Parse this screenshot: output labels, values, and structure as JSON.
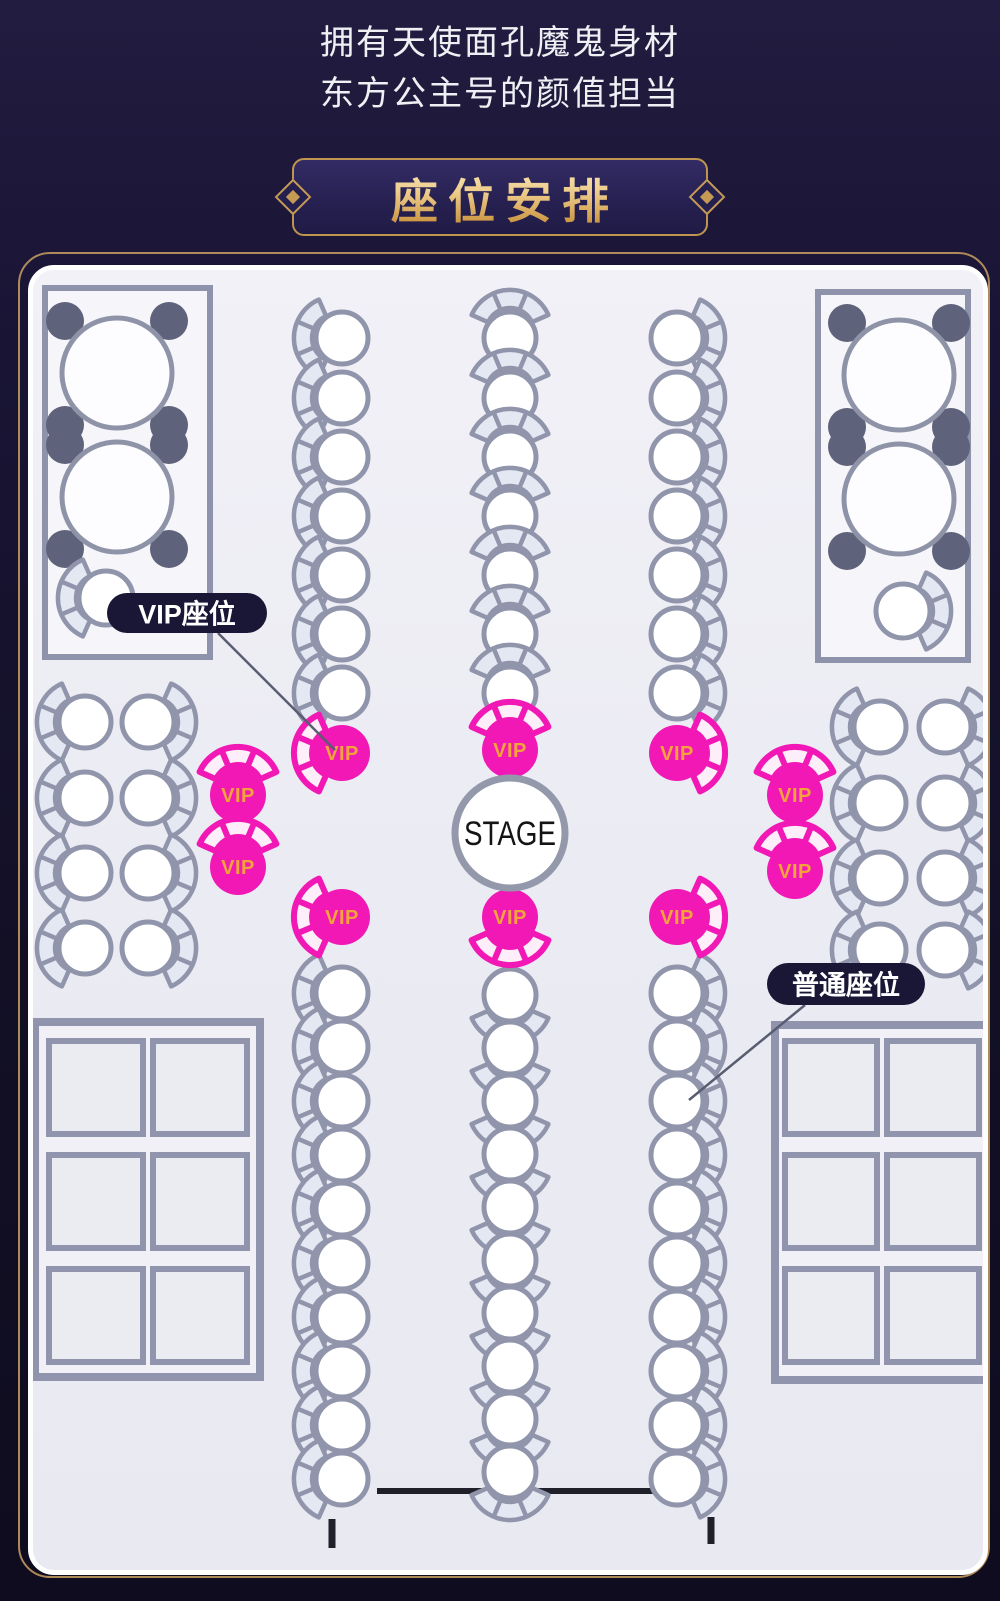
{
  "header": {
    "line1": "拥有天使面孔魔鬼身材",
    "line2": "东方公主号的颜值担当"
  },
  "banner": {
    "title": "座位安排"
  },
  "stage": {
    "label": "STAGE"
  },
  "seat_labels": {
    "vip": "VIP座位",
    "regular": "普通座位",
    "vip_seat_text": "VIP"
  },
  "colors": {
    "page_bg": "#17122c",
    "banner_border": "#c0954f",
    "gold_outline": "#c9a063",
    "map_bg": "#eeedf5",
    "chair_stroke": "#9095ab",
    "chair_fill": "#ffffff",
    "fan_fill": "#e3e8f2",
    "vip_pink": "#f118b6",
    "vip_fan_fill": "#fdeef9",
    "vip_text": "#f2a43a",
    "dark_chair": "#5e627a",
    "table_fill": "#fdfdff",
    "table_stroke": "#8e93a8",
    "rect_stroke": "#8e92aa",
    "rect_fill": "#f6f6fa",
    "grid_stroke": "#9094ac",
    "grid_fill": "#ebebf2",
    "grid_outer_fill": "#f0f0f6",
    "stage_stroke": "#9398ab",
    "stage_text": "#141414",
    "pill_bg": "#191636",
    "pill_text": "#ffffff",
    "leader_line": "#585d72",
    "runway": "#20202b"
  },
  "seat_map": {
    "viewbox": [
      28,
      265,
      950,
      1300
    ],
    "regular_seats": [
      [
        337,
        333,
        "left"
      ],
      [
        337,
        393,
        "left"
      ],
      [
        337,
        452,
        "left"
      ],
      [
        337,
        511,
        "left"
      ],
      [
        337,
        570,
        "left"
      ],
      [
        337,
        629,
        "left"
      ],
      [
        337,
        688,
        "left"
      ],
      [
        505,
        333,
        "up"
      ],
      [
        505,
        393,
        "up"
      ],
      [
        505,
        452,
        "up"
      ],
      [
        505,
        511,
        "up"
      ],
      [
        505,
        570,
        "up"
      ],
      [
        505,
        629,
        "up"
      ],
      [
        505,
        688,
        "up"
      ],
      [
        672,
        333,
        "right"
      ],
      [
        672,
        393,
        "right"
      ],
      [
        672,
        452,
        "right"
      ],
      [
        672,
        511,
        "right"
      ],
      [
        672,
        570,
        "right"
      ],
      [
        672,
        629,
        "right"
      ],
      [
        672,
        688,
        "right"
      ],
      [
        337,
        988,
        "left"
      ],
      [
        337,
        1042,
        "left"
      ],
      [
        337,
        1096,
        "left"
      ],
      [
        337,
        1150,
        "left"
      ],
      [
        337,
        1204,
        "left"
      ],
      [
        337,
        1258,
        "left"
      ],
      [
        337,
        1312,
        "left"
      ],
      [
        337,
        1366,
        "left"
      ],
      [
        337,
        1420,
        "left"
      ],
      [
        337,
        1474,
        "left"
      ],
      [
        505,
        990,
        "down"
      ],
      [
        505,
        1043,
        "down"
      ],
      [
        505,
        1096,
        "down"
      ],
      [
        505,
        1149,
        "down"
      ],
      [
        505,
        1202,
        "down"
      ],
      [
        505,
        1255,
        "down"
      ],
      [
        505,
        1308,
        "down"
      ],
      [
        505,
        1361,
        "down"
      ],
      [
        505,
        1414,
        "down"
      ],
      [
        505,
        1467,
        "down"
      ],
      [
        672,
        988,
        "right"
      ],
      [
        672,
        1042,
        "right"
      ],
      [
        672,
        1096,
        "right"
      ],
      [
        672,
        1150,
        "right"
      ],
      [
        672,
        1204,
        "right"
      ],
      [
        672,
        1258,
        "right"
      ],
      [
        672,
        1312,
        "right"
      ],
      [
        672,
        1366,
        "right"
      ],
      [
        672,
        1420,
        "right"
      ],
      [
        672,
        1474,
        "right"
      ],
      [
        80,
        717,
        "left"
      ],
      [
        143,
        717,
        "right"
      ],
      [
        80,
        793,
        "left"
      ],
      [
        143,
        793,
        "right"
      ],
      [
        80,
        868,
        "left"
      ],
      [
        143,
        868,
        "right"
      ],
      [
        80,
        943,
        "left"
      ],
      [
        143,
        943,
        "right"
      ],
      [
        875,
        722,
        "left"
      ],
      [
        940,
        722,
        "right"
      ],
      [
        875,
        798,
        "left"
      ],
      [
        940,
        798,
        "right"
      ],
      [
        875,
        873,
        "left"
      ],
      [
        940,
        873,
        "right"
      ],
      [
        875,
        945,
        "left"
      ],
      [
        940,
        945,
        "right"
      ]
    ],
    "vip_seats": [
      [
        337,
        748,
        "left"
      ],
      [
        505,
        745,
        "up"
      ],
      [
        672,
        748,
        "right"
      ],
      [
        233,
        790,
        "up"
      ],
      [
        233,
        862,
        "up"
      ],
      [
        790,
        790,
        "up"
      ],
      [
        790,
        866,
        "up"
      ],
      [
        337,
        912,
        "left"
      ],
      [
        505,
        912,
        "down"
      ],
      [
        672,
        912,
        "right"
      ]
    ],
    "corner_tables": [
      {
        "rect": [
          40,
          283,
          165,
          369
        ],
        "tables": [
          [
            112,
            368
          ],
          [
            112,
            492
          ]
        ],
        "single": [
          101,
          593,
          "left"
        ]
      },
      {
        "rect": [
          813,
          287,
          150,
          368
        ],
        "tables": [
          [
            894,
            370
          ],
          [
            894,
            494
          ]
        ],
        "single": [
          898,
          606,
          "right"
        ]
      }
    ],
    "grids": [
      {
        "outer": [
          30,
          1017,
          225,
          355
        ],
        "cols": [
          44,
          148
        ],
        "rows": [
          1036,
          1150,
          1264
        ],
        "cell_w": 94,
        "cell_h": 93
      },
      {
        "outer": [
          770,
          1020,
          212,
          355
        ],
        "cols": [
          780,
          882
        ],
        "rows": [
          1036,
          1150,
          1264
        ],
        "cell_w": 92,
        "cell_h": 93
      }
    ],
    "runway": {
      "line": [
        372,
        1486,
        658,
        1486
      ],
      "ticks": [
        [
          327,
          1514,
          327,
          1543
        ],
        [
          706,
          1512,
          706,
          1539
        ]
      ]
    },
    "stage_pos": {
      "c": [
        505,
        828
      ],
      "r": 55
    },
    "callouts": [
      {
        "key": "vip",
        "pill": [
          102,
          588,
          160,
          40
        ],
        "line": [
          213,
          628,
          330,
          745
        ]
      },
      {
        "key": "regular",
        "pill": [
          762,
          958,
          158,
          42
        ],
        "line": [
          800,
          1000,
          684,
          1095
        ]
      }
    ]
  }
}
